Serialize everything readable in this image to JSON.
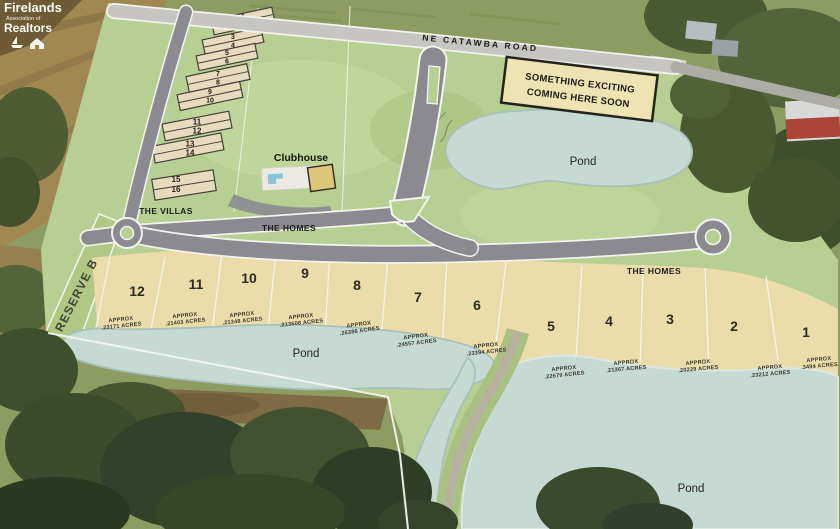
{
  "branding": {
    "name_line1": "Firelands",
    "name_line2": "Association of",
    "name_line3": "Realtors"
  },
  "roads": {
    "catawba": "NE CATAWBA ROAD",
    "villas": "THE VILLAS",
    "homes_west": "THE HOMES",
    "homes_east": "THE HOMES"
  },
  "sign": {
    "line1": "SOMETHING EXCITING",
    "line2": "COMING HERE SOON"
  },
  "areas": {
    "clubhouse": "Clubhouse",
    "reserve": "RESERVE B",
    "pond_north": "Pond",
    "pond_west": "Pond",
    "pond_south": "Pond"
  },
  "villa_pairs": [
    {
      "top": "1",
      "bottom": "2"
    },
    {
      "top": "3",
      "bottom": "4"
    },
    {
      "top": "5",
      "bottom": "6"
    },
    {
      "top": "7",
      "bottom": "8"
    },
    {
      "top": "9",
      "bottom": "10"
    },
    {
      "top": "11",
      "bottom": "12"
    },
    {
      "top": "13",
      "bottom": "14"
    },
    {
      "top": "15",
      "bottom": "16"
    }
  ],
  "home_lots": [
    {
      "number": "12",
      "approx": "APPROX",
      "acres": ".23171 ACRES"
    },
    {
      "number": "11",
      "approx": "APPROX",
      "acres": ".21403 ACRES"
    },
    {
      "number": "10",
      "approx": "APPROX",
      "acres": ".21348 ACRES"
    },
    {
      "number": "9",
      "approx": "APPROX",
      "acres": ".213608 ACRES"
    },
    {
      "number": "8",
      "approx": "APPROX",
      "acres": ".26386 ACRES"
    },
    {
      "number": "7",
      "approx": "APPROX",
      "acres": ".24557 ACRES"
    },
    {
      "number": "6",
      "approx": "APPROX",
      "acres": ".23394 ACRES"
    },
    {
      "number": "5",
      "approx": "APPROX",
      "acres": ".22679 ACRES"
    },
    {
      "number": "4",
      "approx": "APPROX",
      "acres": ".21367 ACRES"
    },
    {
      "number": "3",
      "approx": "APPROX",
      "acres": ".20229 ACRES"
    },
    {
      "number": "2",
      "approx": "APPROX",
      "acres": ".23212 ACRES"
    },
    {
      "number": "1",
      "approx": "APPROX",
      "acres": ".3494 ACRES"
    }
  ],
  "colors": {
    "plan_green": "#b7cf92",
    "lot_tan": "#ecdcaa",
    "pond_blue": "#c6dad4",
    "road_gray": "#8b8a90",
    "catawba_gray": "#c6c5c1",
    "sign_tan": "#eee3b2"
  }
}
